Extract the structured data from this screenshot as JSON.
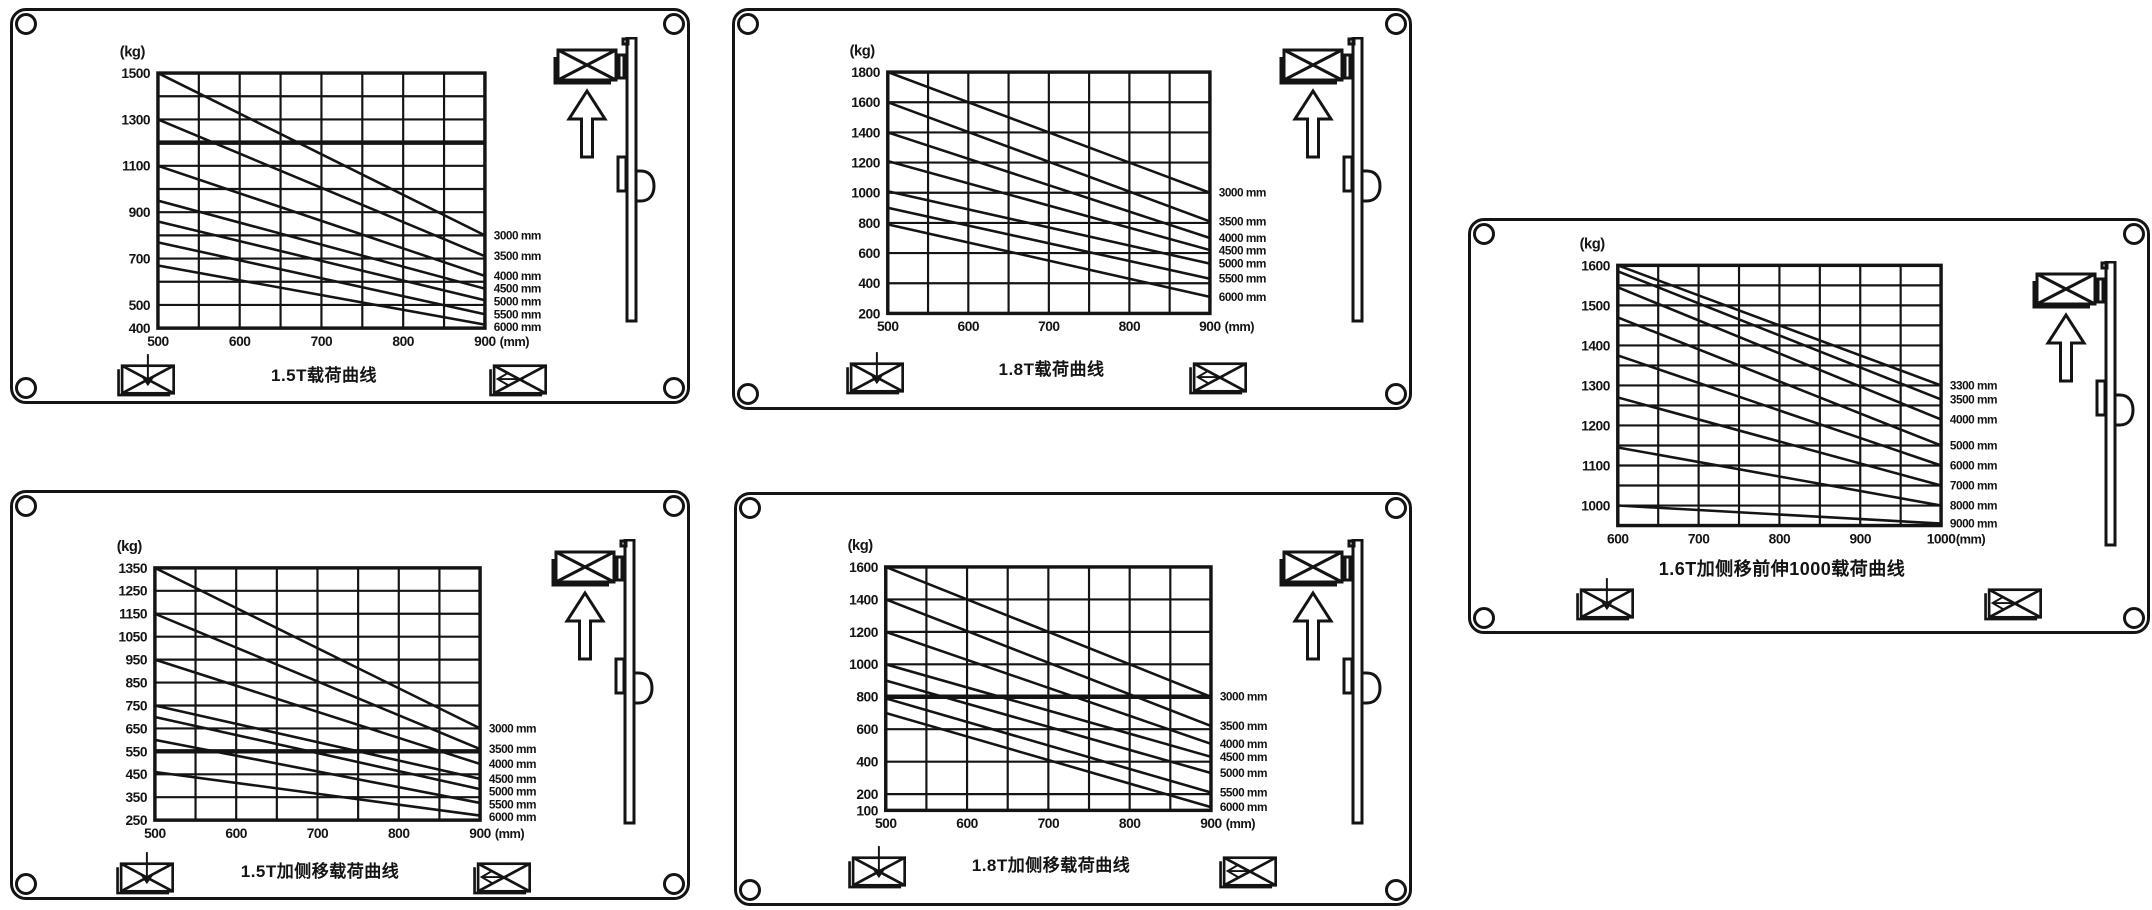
{
  "page": {
    "background": "#ffffff",
    "ink_color": "#141414",
    "description_tags": [
      "forklift-load-capacity-nameplates"
    ]
  },
  "icons": {
    "mast-lift-icon": "outline forklift mast with crossed load box on forks and hollow up arrow",
    "load-lower-icon": "crossed load box with downward arrow",
    "load-side-shift-icon": "crossed load box with left-pointing arrow",
    "screw-hole-icon": "corner mounting hole ring"
  },
  "chart_data": [
    {
      "type": "line",
      "title": "1.5T载荷曲线",
      "ylabel": "(kg)",
      "xlabel": "(mm)",
      "series_unit": "mm",
      "legend_position": "right",
      "grid": true,
      "xlim": [
        500,
        900
      ],
      "ylim": [
        400,
        1500
      ],
      "x_ticks": [
        500,
        600,
        700,
        800,
        900
      ],
      "x_grid_step": 50,
      "y_ticks": [
        1500,
        1300,
        1100,
        900,
        700,
        500,
        400
      ],
      "y_gridlines": [
        1500,
        1400,
        1300,
        1200,
        1100,
        1000,
        900,
        800,
        700,
        600,
        500,
        400
      ],
      "y_bold": [
        1200
      ],
      "series": [
        {
          "name": "3000",
          "values": [
            1500,
            800
          ]
        },
        {
          "name": "3500",
          "values": [
            1300,
            710
          ]
        },
        {
          "name": "4000",
          "values": [
            1100,
            625
          ]
        },
        {
          "name": "4500",
          "values": [
            950,
            570
          ]
        },
        {
          "name": "5000",
          "values": [
            860,
            520
          ]
        },
        {
          "name": "5500",
          "values": [
            770,
            460
          ]
        },
        {
          "name": "6000",
          "values": [
            670,
            415
          ]
        }
      ]
    },
    {
      "type": "line",
      "title": "1.8T载荷曲线",
      "ylabel": "(kg)",
      "xlabel": "(mm)",
      "series_unit": "mm",
      "legend_position": "right",
      "grid": true,
      "xlim": [
        500,
        900
      ],
      "ylim": [
        200,
        1800
      ],
      "x_ticks": [
        500,
        600,
        700,
        800,
        900
      ],
      "x_grid_step": 50,
      "y_ticks": [
        1800,
        1600,
        1400,
        1200,
        1000,
        800,
        600,
        400,
        200
      ],
      "y_gridlines": [
        1800,
        1600,
        1400,
        1200,
        1000,
        800,
        600,
        400,
        200
      ],
      "y_bold": [],
      "series": [
        {
          "name": "3000",
          "values": [
            1800,
            1000
          ]
        },
        {
          "name": "3500",
          "values": [
            1600,
            810
          ]
        },
        {
          "name": "4000",
          "values": [
            1400,
            700
          ]
        },
        {
          "name": "4500",
          "values": [
            1210,
            620
          ]
        },
        {
          "name": "5000",
          "values": [
            1010,
            530
          ]
        },
        {
          "name": "5500",
          "values": [
            900,
            430
          ]
        },
        {
          "name": "6000",
          "values": [
            790,
            310
          ]
        }
      ]
    },
    {
      "type": "line",
      "title": "1.6T加侧移前伸1000载荷曲线",
      "ylabel": "(kg)",
      "xlabel": "(mm)",
      "series_unit": "mm",
      "legend_position": "right",
      "grid": true,
      "xlim": [
        600,
        1000
      ],
      "ylim": [
        950,
        1600
      ],
      "x_ticks": [
        600,
        700,
        800,
        900,
        1000
      ],
      "x_grid_step": 50,
      "y_ticks": [
        1600,
        1500,
        1400,
        1300,
        1200,
        1100,
        1000
      ],
      "y_gridlines": [
        1600,
        1550,
        1500,
        1450,
        1400,
        1350,
        1300,
        1250,
        1200,
        1150,
        1100,
        1050,
        1000,
        950
      ],
      "y_bold": [],
      "series": [
        {
          "name": "3300",
          "values": [
            1600,
            1300
          ]
        },
        {
          "name": "3500",
          "values": [
            1585,
            1265
          ]
        },
        {
          "name": "4000",
          "values": [
            1545,
            1215
          ]
        },
        {
          "name": "5000",
          "values": [
            1470,
            1150
          ]
        },
        {
          "name": "6000",
          "values": [
            1375,
            1100
          ]
        },
        {
          "name": "7000",
          "values": [
            1270,
            1050
          ]
        },
        {
          "name": "8000",
          "values": [
            1145,
            1000
          ]
        },
        {
          "name": "9000",
          "values": [
            1000,
            955
          ]
        }
      ]
    },
    {
      "type": "line",
      "title": "1.5T加侧移载荷曲线",
      "ylabel": "(kg)",
      "xlabel": "(mm)",
      "series_unit": "mm",
      "legend_position": "right",
      "grid": true,
      "xlim": [
        500,
        900
      ],
      "ylim": [
        250,
        1350
      ],
      "x_ticks": [
        500,
        600,
        700,
        800,
        900
      ],
      "x_grid_step": 50,
      "y_ticks": [
        1350,
        1250,
        1150,
        1050,
        950,
        850,
        750,
        650,
        550,
        450,
        350,
        250
      ],
      "y_gridlines": [
        1350,
        1250,
        1150,
        1050,
        950,
        850,
        750,
        650,
        550,
        450,
        350,
        250
      ],
      "y_bold": [
        550
      ],
      "series": [
        {
          "name": "3000",
          "values": [
            1350,
            650
          ]
        },
        {
          "name": "3500",
          "values": [
            1150,
            560
          ]
        },
        {
          "name": "4000",
          "values": [
            950,
            495
          ]
        },
        {
          "name": "4500",
          "values": [
            750,
            430
          ]
        },
        {
          "name": "5000",
          "values": [
            700,
            385
          ]
        },
        {
          "name": "5500",
          "values": [
            600,
            325
          ]
        },
        {
          "name": "6000",
          "values": [
            460,
            270
          ]
        }
      ]
    },
    {
      "type": "line",
      "title": "1.8T加侧移载荷曲线",
      "ylabel": "(kg)",
      "xlabel": "(mm)",
      "series_unit": "mm",
      "legend_position": "right",
      "grid": true,
      "xlim": [
        500,
        900
      ],
      "ylim": [
        100,
        1600
      ],
      "x_ticks": [
        500,
        600,
        700,
        800,
        900
      ],
      "x_grid_step": 50,
      "y_ticks": [
        1600,
        1400,
        1200,
        1000,
        800,
        600,
        400,
        200,
        100
      ],
      "y_gridlines": [
        1600,
        1400,
        1200,
        1000,
        800,
        600,
        400,
        200,
        100
      ],
      "y_bold": [
        800
      ],
      "series": [
        {
          "name": "3000",
          "values": [
            1600,
            800
          ]
        },
        {
          "name": "3500",
          "values": [
            1400,
            620
          ]
        },
        {
          "name": "4000",
          "values": [
            1200,
            510
          ]
        },
        {
          "name": "4500",
          "values": [
            1000,
            430
          ]
        },
        {
          "name": "5000",
          "values": [
            900,
            330
          ]
        },
        {
          "name": "5500",
          "values": [
            790,
            210
          ]
        },
        {
          "name": "6000",
          "values": [
            700,
            120
          ]
        }
      ]
    }
  ]
}
